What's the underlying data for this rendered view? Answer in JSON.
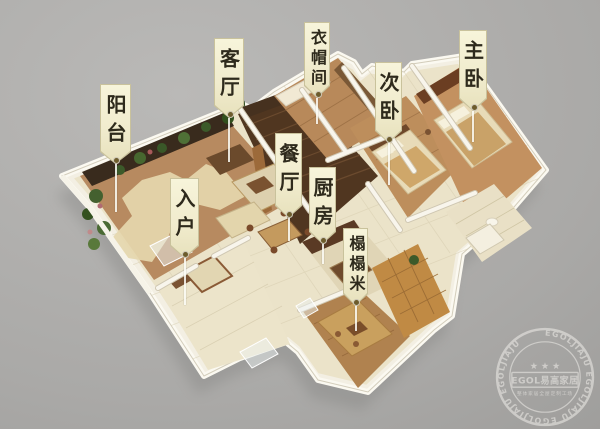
{
  "scene": {
    "description": "3D isometric cutaway render of an apartment floor plan on a gray background with room callout labels",
    "background_color": "#aaa9a7"
  },
  "labels": {
    "balcony": {
      "text": "阳台"
    },
    "living_room": {
      "text": "客厅"
    },
    "cloakroom": {
      "text": "衣帽间"
    },
    "second_bedroom": {
      "text": "次卧"
    },
    "master_bedroom": {
      "text": "主卧"
    },
    "dining_room": {
      "text": "餐厅"
    },
    "entrance": {
      "text": "入户"
    },
    "kitchen": {
      "text": "厨房"
    },
    "tatami": {
      "text": "榻榻米"
    }
  },
  "watermark": {
    "ring_text": "EGOLJIAJU   EGOLJIAJU   EGOLJIAJU   EGOLJIAJU",
    "stars": "★ ★ ★",
    "box_text": "EGOL易高家居",
    "tagline": "整体家居全屋定制工场"
  },
  "palette": {
    "tag_background": "#f3efd2",
    "tag_text": "#2e2a1c",
    "background_gray": "#aaa9a7",
    "wall_white": "#f6f3e8",
    "dark_wood_floor": "#503620",
    "bedroom_wood_floor": "#bd8e5c",
    "tile_floor": "#ebe3c9",
    "terrace_tile": "#c08a44",
    "balcony_tile": "#b78a60",
    "plant_green": "#47672f",
    "accent_brown": "#6b3e22",
    "watermark_gray": "#eceae6"
  }
}
